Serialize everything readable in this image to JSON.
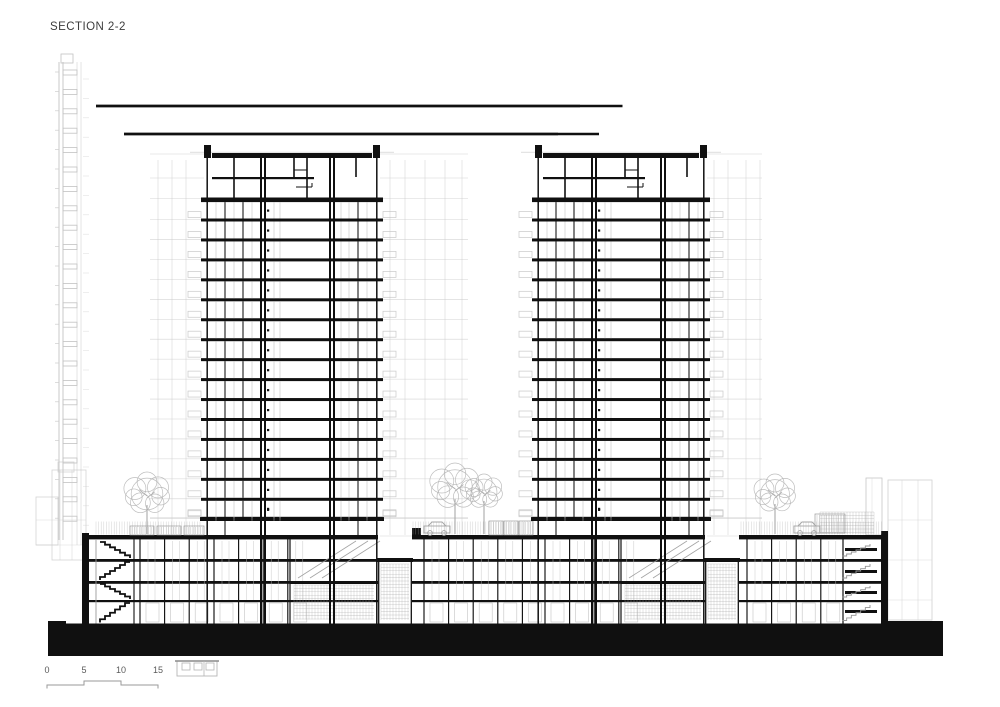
{
  "title": "SECTION 2-2",
  "scale_bar": {
    "labels": [
      "0",
      "5",
      "10",
      "15"
    ]
  },
  "palette": {
    "ink": "#101010",
    "grey": "#c6c6c6",
    "greyMid": "#9e9e9e",
    "greyDark": "#8a8a8a",
    "paper": "#ffffff",
    "tree": "#b2b2b2"
  },
  "drawing": {
    "width": 1000,
    "height": 707,
    "ground": {
      "points": "48,656 48,621 66,621 66,623.5 886,623.5 886,621 943,621 943,656"
    },
    "podium": {
      "yTop": 535,
      "floorYs": [
        559,
        581,
        600
      ],
      "yGround": 623.5,
      "sections": [
        {
          "x0": 82,
          "x1": 206,
          "type": "grid",
          "wallL": 7,
          "stairs": "black",
          "stairX": 96,
          "partStart": 140
        },
        {
          "x0": 206,
          "x1": 378,
          "type": "underTower"
        },
        {
          "x0": 378,
          "x1": 412,
          "type": "terrace"
        },
        {
          "x0": 412,
          "x1": 537,
          "type": "grid",
          "parapetStep": true,
          "partStart": 424
        },
        {
          "x0": 537,
          "x1": 705,
          "type": "underTower"
        },
        {
          "x0": 705,
          "x1": 739,
          "type": "terrace"
        },
        {
          "x0": 739,
          "x1": 888,
          "type": "grid",
          "wallR": 7,
          "stairs": "grey",
          "stairX": 840,
          "partStart": 747
        }
      ]
    },
    "towers": [
      {
        "x0": 206,
        "w": 172
      },
      {
        "x0": 537,
        "w": 168
      }
    ],
    "towerSpec": {
      "parapetY": 145,
      "roofY": 153,
      "pentMidY": 177,
      "slab2Y": 197.5,
      "typStart": 218.5,
      "typSpacing": 19.95,
      "typCount": 15,
      "heavyY": 516.8,
      "lobbyY": 535,
      "yGround": 623.5,
      "blackParts": [
        19,
        37,
        152
      ],
      "greyParts": [
        10,
        28,
        46,
        68,
        74,
        135,
        143,
        161
      ],
      "coreA": [
        55,
        59
      ],
      "coreB": [
        124,
        128
      ]
    },
    "wings": [
      {
        "x0": 150,
        "x1": 204,
        "verts": [
          158,
          172,
          186
        ]
      },
      {
        "x0": 380,
        "x1": 468,
        "verts": [
          390,
          405,
          425,
          445,
          462
        ]
      },
      {
        "x0": 707,
        "x1": 762,
        "verts": [
          714,
          728,
          746,
          760
        ]
      }
    ],
    "trees": [
      {
        "cx": 147,
        "cy": 494,
        "r": 22
      },
      {
        "cx": 455,
        "cy": 487,
        "r": 24
      },
      {
        "cx": 484,
        "cy": 492,
        "r": 18
      },
      {
        "cx": 775,
        "cy": 494,
        "r": 20
      }
    ],
    "cars": [
      {
        "x": 424,
        "y": 521
      },
      {
        "x": 794,
        "y": 521
      }
    ],
    "railings": [
      {
        "x0": 96,
        "x1": 200
      },
      {
        "x0": 413,
        "x1": 534
      },
      {
        "x0": 741,
        "x1": 883
      }
    ],
    "planters": [
      [
        130,
        526,
        24,
        9
      ],
      [
        157,
        526,
        24,
        9
      ],
      [
        184,
        526,
        20,
        9
      ],
      [
        489,
        521,
        14,
        14
      ],
      [
        504,
        521,
        14,
        14
      ],
      [
        519,
        521,
        14,
        14
      ],
      [
        815,
        514,
        30,
        19
      ]
    ],
    "mast": {
      "x": 59,
      "yTop": 62,
      "yBot": 540,
      "step": 19.4
    },
    "leftBuildings": [
      [
        36,
        497,
        22,
        48
      ],
      [
        52,
        470,
        34,
        90
      ],
      [
        58,
        462,
        16,
        10
      ]
    ],
    "rightBackground": {
      "chimney": [
        866,
        478,
        16,
        57
      ],
      "hatch": [
        820,
        512,
        54,
        22
      ],
      "block": [
        888,
        480,
        44,
        140
      ]
    },
    "legendIcon": {
      "x": 177,
      "y": 659
    },
    "scaleLine": {
      "x": [
        47,
        84,
        121,
        158
      ],
      "yLow": 685,
      "yHigh": 681,
      "tick": 3.5
    }
  }
}
